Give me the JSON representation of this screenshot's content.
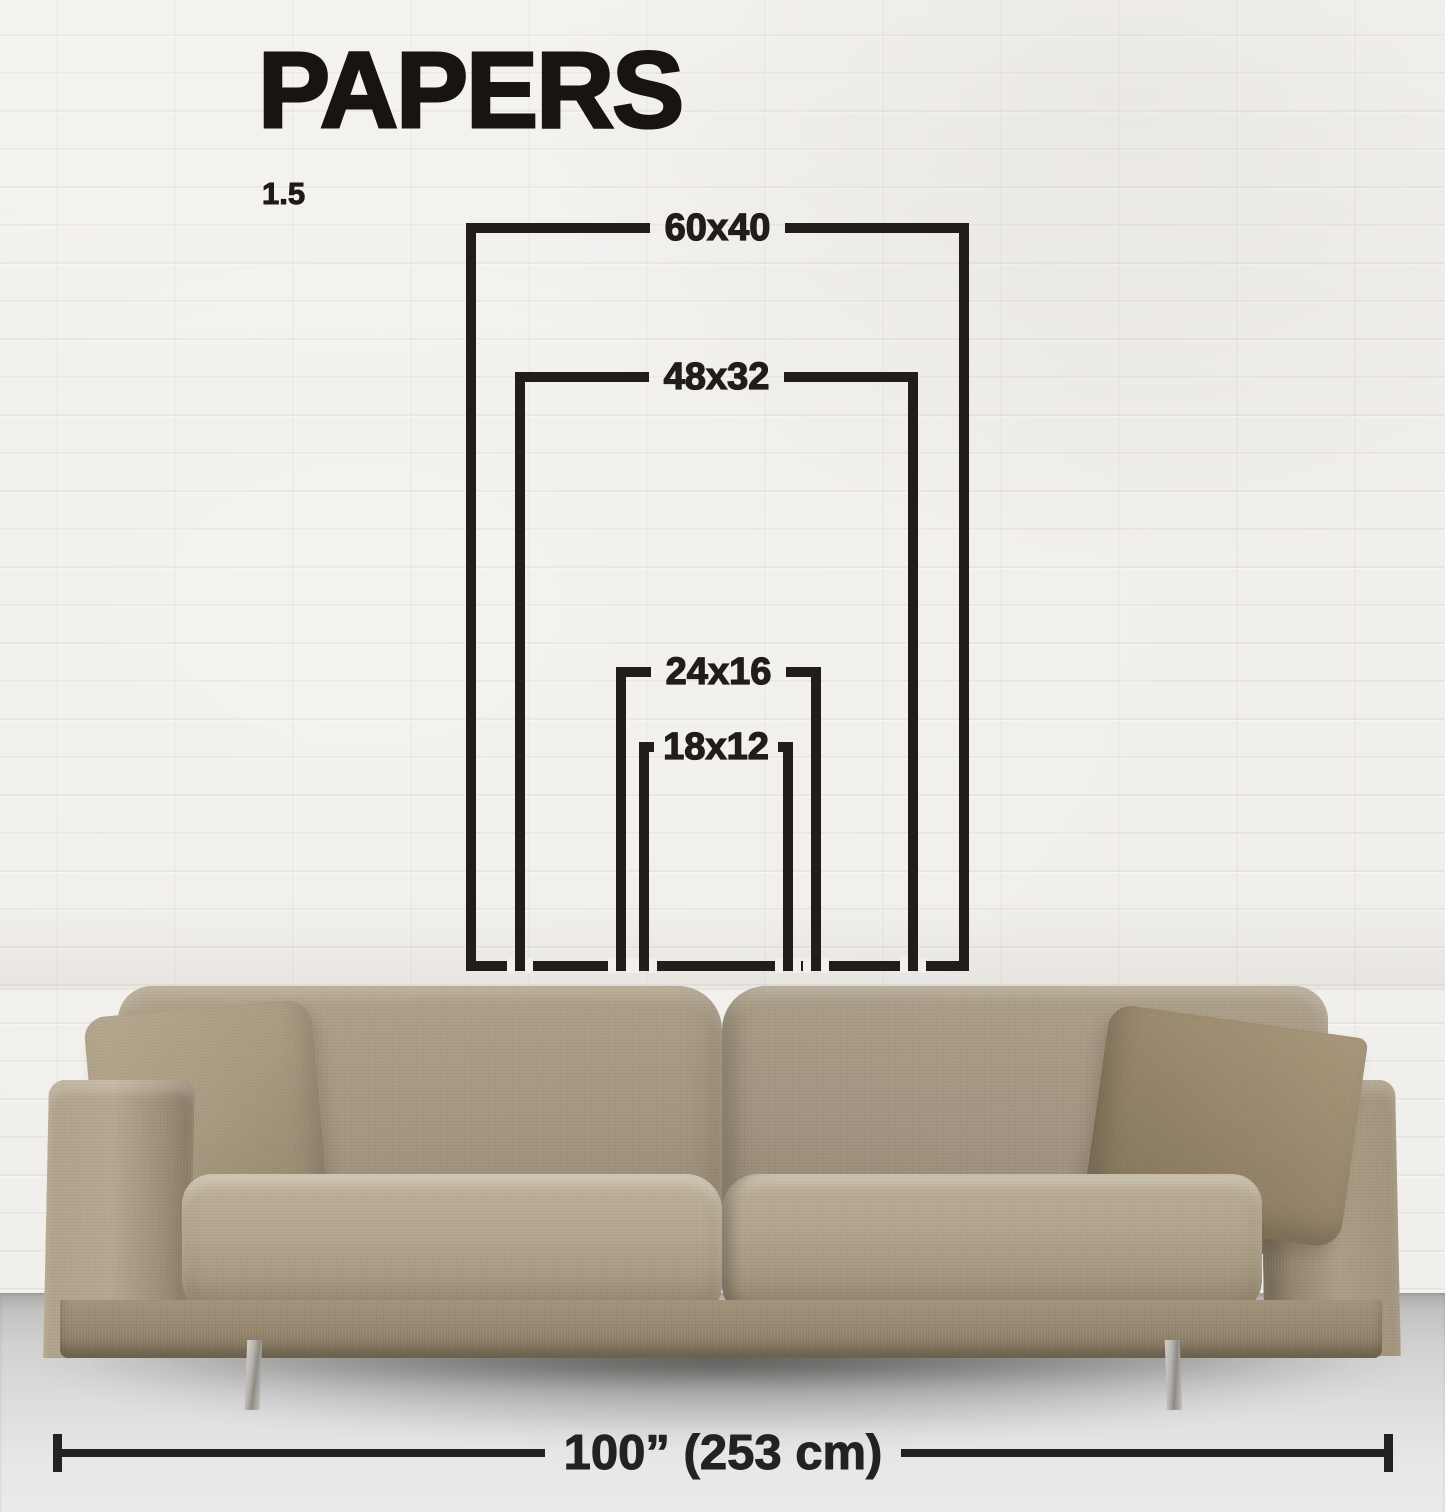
{
  "title": "PAPERS",
  "ratio_label": "1.5",
  "diagram": {
    "sizes": [
      {
        "label": "60x40",
        "height_in": 60,
        "width_in": 40
      },
      {
        "label": "48x32",
        "height_in": 48,
        "width_in": 32
      },
      {
        "label": "24x16",
        "height_in": 24,
        "width_in": 16
      },
      {
        "label": "18x12",
        "height_in": 18,
        "width_in": 12
      }
    ],
    "width_measure": {
      "label": "100” (253 cm)",
      "inches": 100,
      "cm": 253
    },
    "aspect_ratio": 1.5
  },
  "colors": {
    "ink": "#201d1b",
    "wall": "#f1efeb",
    "floor": "#dfe0e2",
    "sofa_fabric": "#a89a81",
    "pillow": "#9a8a6e",
    "metal_leg": "#b7b4af"
  }
}
